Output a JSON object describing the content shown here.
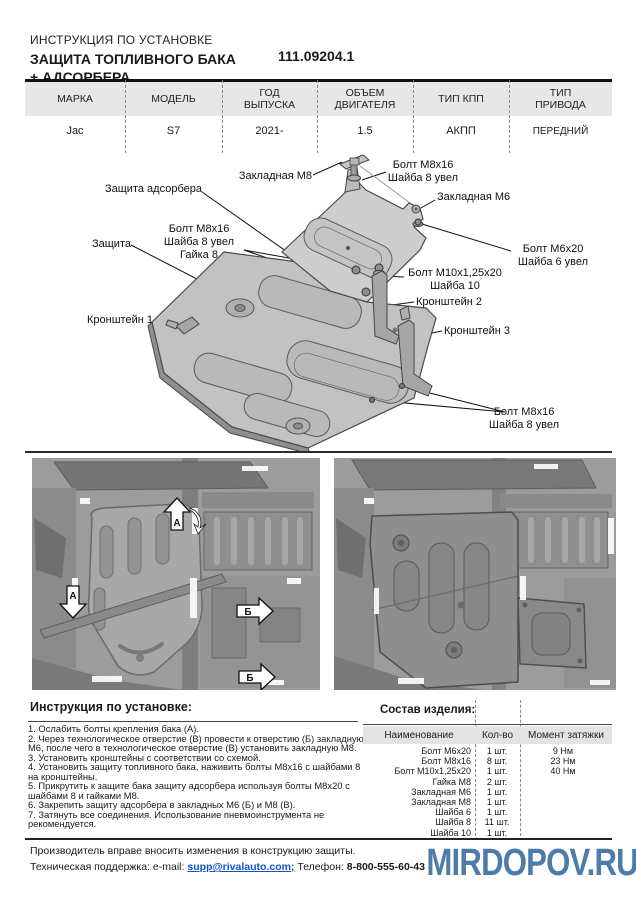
{
  "header": {
    "doc_type": "ИНСТРУКЦИЯ ПО УСТАНОВКЕ",
    "title": "ЗАЩИТА ТОПЛИВНОГО БАКА\n+ АДСОРБЕРА",
    "part_number": "111.09204.1"
  },
  "vehicle_table": {
    "headers": [
      "МАРКА",
      "МОДЕЛЬ",
      "ГОД\nВЫПУСКА",
      "ОБЪЕМ\nДВИГАТЕЛЯ",
      "ТИП КПП",
      "ТИП\nПРИВОДА"
    ],
    "row": [
      "Jac",
      "S7",
      "2021-",
      "1.5",
      "АКПП",
      "ПЕРЕДНИЙ"
    ]
  },
  "diagram": {
    "callouts": [
      {
        "text": "Закладная М8"
      },
      {
        "text": "Болт М8х16\nШайба 8 увел"
      },
      {
        "text": "Защита адсорбера"
      },
      {
        "text": "Закладная М6"
      },
      {
        "text": "Болт М8х16\nШайба 8 увел\nГайка 8"
      },
      {
        "text": "Защита"
      },
      {
        "text": "Болт М6х20\nШайба 6 увел"
      },
      {
        "text": "Болт М10х1,25х20\nШайба 10"
      },
      {
        "text": "Кронштейн 2"
      },
      {
        "text": "Кронштейн 1"
      },
      {
        "text": "Кронштейн 3"
      },
      {
        "text": "Болт М8х16\nШайба 8 увел"
      }
    ]
  },
  "photos": {
    "markers": {
      "a": "А",
      "b": "Б"
    }
  },
  "instructions": {
    "heading": "Инструкция по установке:",
    "steps": [
      "1. Ослабить болты крепления бака (А).",
      "2. Через технологическое отверстие (В) провести к отверстию (Б) закладную М6, после чего в технологическое отверстие (В) установить закладную М8.",
      "3. Установить кронштейны с соответствии со схемой.",
      "4. Установить защиту топливного бака, наживить болты М8х16 с шайбами 8 на кронштейны.",
      "5. Прикрутить к защите бака защиту адсорбера используя болты М8х20 с шайбами 8 и гайками М8.",
      "6. Закрепить защиту адсорбера в закладных М6 (Б) и М8 (В).",
      "7. Затянуть все соединения. Использование пневмоинструмента не рекомендуется."
    ]
  },
  "parts": {
    "heading": "Состав изделия:",
    "columns": [
      "Наименование",
      "Кол-во",
      "Момент затяжки"
    ],
    "rows": [
      {
        "name": "Болт М6х20",
        "qty": "1 шт.",
        "torque": "9 Нм"
      },
      {
        "name": "Болт М8х16",
        "qty": "8 шт.",
        "torque": "23 Нм"
      },
      {
        "name": "Болт М10х1,25х20",
        "qty": "1 шт.",
        "torque": "40 Нм"
      },
      {
        "name": "Гайка М8",
        "qty": "2 шт.",
        "torque": ""
      },
      {
        "name": "Закладная М6",
        "qty": "1 шт.",
        "torque": ""
      },
      {
        "name": "Закладная М8",
        "qty": "1 шт.",
        "torque": ""
      },
      {
        "name": "Шайба 6",
        "qty": "1 шт.",
        "torque": ""
      },
      {
        "name": "Шайба 8",
        "qty": "11 шт.",
        "torque": ""
      },
      {
        "name": "Шайба 10",
        "qty": "1 шт.",
        "torque": ""
      }
    ]
  },
  "footer": {
    "line1": "Производитель вправе вносить изменения в конструкцию защиты.",
    "support_label": "Техническая поддержка:  e-mail: ",
    "email": "supp@rivalauto.com;",
    "phone_label": " Телефон: ",
    "phone": "8-800-555-60-43",
    "watermark": "MIRDOPOV.RU"
  },
  "colors": {
    "watermark_blue": "#4d7cab",
    "link_blue": "#1353c8",
    "table_header_bg": "#e7e7e7"
  }
}
